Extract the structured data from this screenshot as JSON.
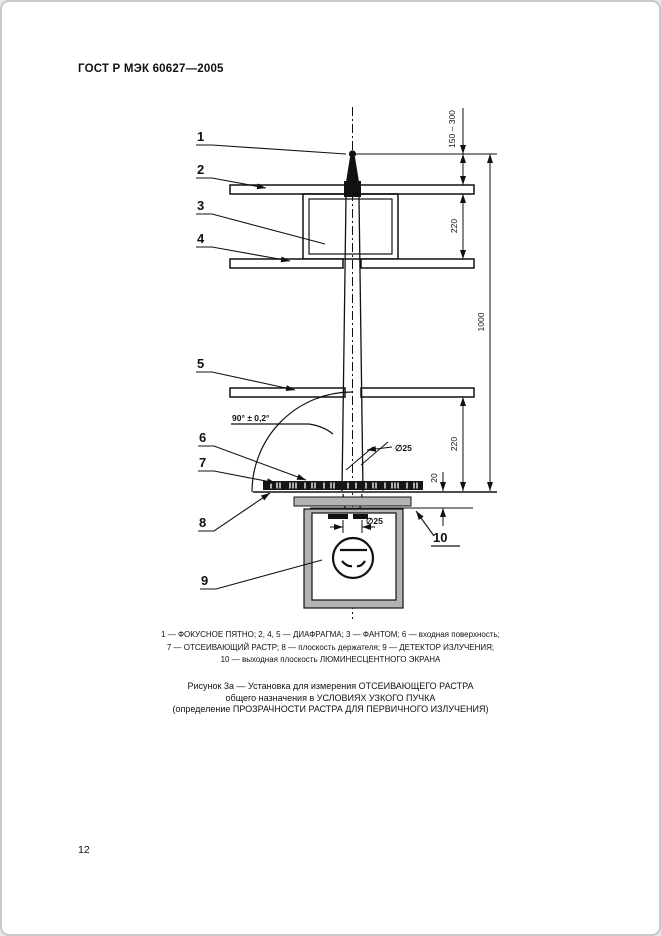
{
  "page": {
    "header": "ГОСТ Р МЭК 60627—2005",
    "page_number": "12"
  },
  "figure": {
    "part_labels": [
      "1",
      "2",
      "3",
      "4",
      "5",
      "6",
      "7",
      "8",
      "9",
      "10"
    ],
    "dims": {
      "focus_to_diaphragm": "150 – 300",
      "diaphragm_spacing_top": "220",
      "diaphragm_to_grid": "220",
      "focus_to_grid_total": "1000",
      "grid_to_screen": "20",
      "beam_diameter_at_grid": "∅25",
      "beam_diameter_at_screen": "∅25",
      "grid_angle": "90° ± 0,2°"
    },
    "legend_lines": [
      "1 — ФОКУСНОЕ ПЯТНО; 2, 4, 5 — ДИАФРАГМА; 3 — ФАНТОМ; 6 — входная поверхность;",
      "7 — ОТСЕИВАЮЩИЙ РАСТР; 8 — плоскость держателя; 9 — ДЕТЕКТОР ИЗЛУЧЕНИЯ;",
      "10 — выходная плоскость ЛЮМИНЕСЦЕНТНОГО ЭКРАНА"
    ],
    "caption_lines": [
      "Рисунок 3а — Установка для измерения ОТСЕИВАЮЩЕГО РАСТРА",
      "общего назначения в УСЛОВИЯХ УЗКОГО ПУЧКА",
      "(определение ПРОЗРАЧНОСТИ РАСТРА ДЛЯ ПЕРВИЧНОГО ИЗЛУЧЕНИЯ)"
    ]
  }
}
